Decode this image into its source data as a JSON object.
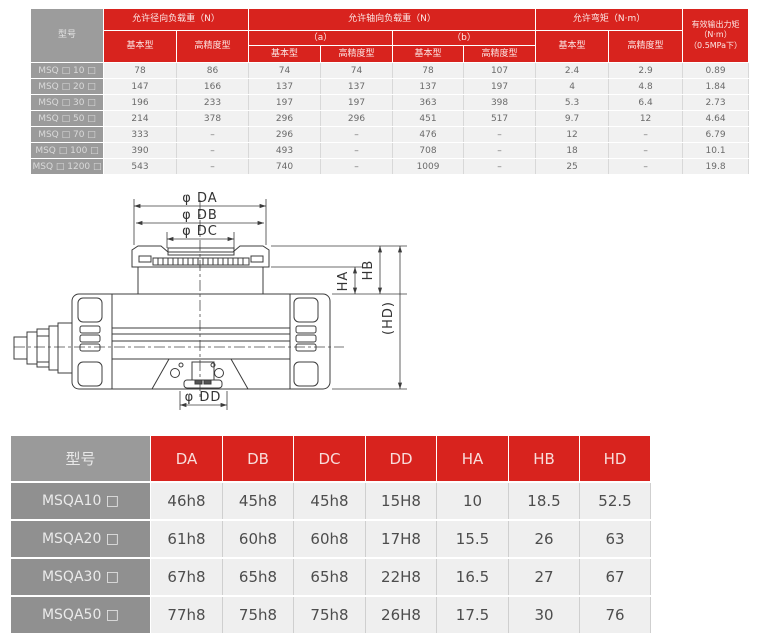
{
  "colors": {
    "accent_red": "#d8231e",
    "model_gray": "#909090",
    "cell_gray": "#efefef"
  },
  "top_table": {
    "model_header": "型号",
    "h_radial": "允许径向负载重（N）",
    "h_axial": "允许轴向负载重（N）",
    "h_moment": "允许弯矩（N·m）",
    "h_basic": "基本型",
    "h_precision": "高精度型",
    "h_a": "（a）",
    "h_b": "（b）",
    "output_line1": "有效输出力矩",
    "output_line2": "（N·m）",
    "output_line3": "（0.5MPa下）",
    "rows": [
      {
        "model": "MSQ □ 10 □",
        "values": [
          "78",
          "86",
          "74",
          "74",
          "78",
          "107",
          "2.4",
          "2.9",
          "0.89"
        ]
      },
      {
        "model": "MSQ □ 20 □",
        "values": [
          "147",
          "166",
          "137",
          "137",
          "137",
          "197",
          "4",
          "4.8",
          "1.84"
        ]
      },
      {
        "model": "MSQ □ 30 □",
        "values": [
          "196",
          "233",
          "197",
          "197",
          "363",
          "398",
          "5.3",
          "6.4",
          "2.73"
        ]
      },
      {
        "model": "MSQ □ 50 □",
        "values": [
          "214",
          "378",
          "296",
          "296",
          "451",
          "517",
          "9.7",
          "12",
          "4.64"
        ]
      },
      {
        "model": "MSQ □ 70 □",
        "values": [
          "333",
          "–",
          "296",
          "–",
          "476",
          "–",
          "12",
          "–",
          "6.79"
        ]
      },
      {
        "model": "MSQ □ 100 □",
        "values": [
          "390",
          "–",
          "493",
          "–",
          "708",
          "–",
          "18",
          "–",
          "10.1"
        ]
      },
      {
        "model": "MSQ □ 1200 □",
        "values": [
          "543",
          "–",
          "740",
          "–",
          "1009",
          "–",
          "25",
          "–",
          "19.8"
        ]
      }
    ]
  },
  "diagram": {
    "labels": {
      "da": "φ DA",
      "db": "φ DB",
      "dc": "φ DC",
      "dd": "φ DD",
      "ha": "HA",
      "hb": "HB",
      "hd": "(HD)"
    }
  },
  "bottom_table": {
    "col_model": "型号",
    "columns": [
      "DA",
      "DB",
      "DC",
      "DD",
      "HA",
      "HB",
      "HD"
    ],
    "rows": [
      {
        "model": "MSQA10 □",
        "values": [
          "46h8",
          "45h8",
          "45h8",
          "15H8",
          "10",
          "18.5",
          "52.5"
        ]
      },
      {
        "model": "MSQA20 □",
        "values": [
          "61h8",
          "60h8",
          "60h8",
          "17H8",
          "15.5",
          "26",
          "63"
        ]
      },
      {
        "model": "MSQA30 □",
        "values": [
          "67h8",
          "65h8",
          "65h8",
          "22H8",
          "16.5",
          "27",
          "67"
        ]
      },
      {
        "model": "MSQA50 □",
        "values": [
          "77h8",
          "75h8",
          "75h8",
          "26H8",
          "17.5",
          "30",
          "76"
        ]
      }
    ]
  }
}
